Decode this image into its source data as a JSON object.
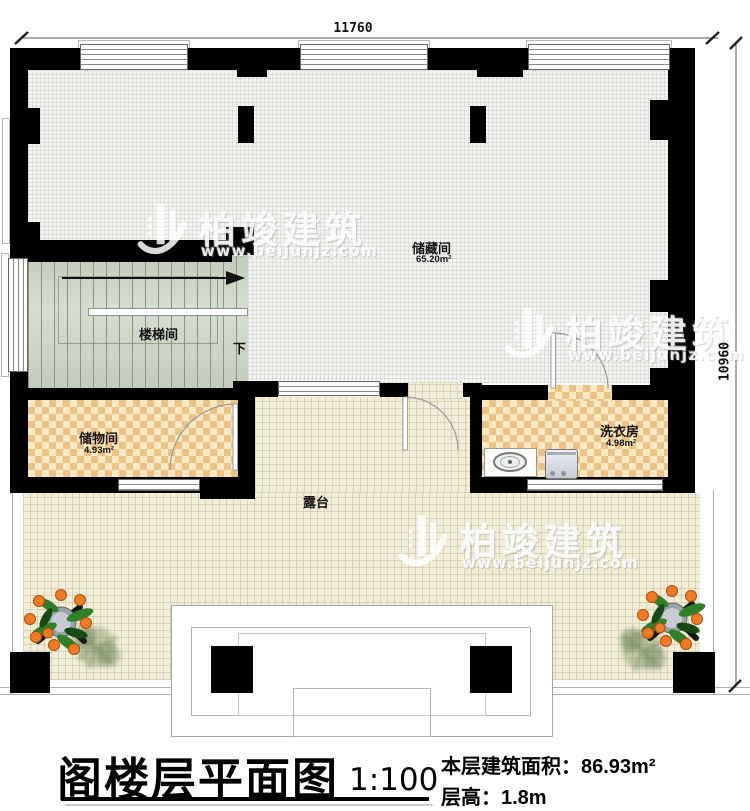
{
  "dimensions": {
    "top": "11760",
    "right": "10960"
  },
  "rooms": {
    "storage": {
      "name": "储藏间",
      "area": "65.20m²"
    },
    "stair": {
      "name": "楼梯间",
      "down": "下"
    },
    "storeroom": {
      "name": "储物间",
      "area": "4.93m²"
    },
    "laundry": {
      "name": "洗衣房",
      "area": "4.98m²"
    },
    "terrace": {
      "name": "露台"
    }
  },
  "watermark": {
    "brand": "柏竣建筑",
    "url": "www.beijunjz.com"
  },
  "title": {
    "main": "阁楼层平面图",
    "scale": "1:100",
    "area_label": "本层建筑面积：",
    "area_value": "86.93m²",
    "height_label": "层高：",
    "height_value": "1.8m"
  },
  "colors": {
    "wall": "#000000",
    "checker_dark": "#ecc285",
    "checker_light": "#f8e8c4",
    "terrace_floor": "#f1edd8",
    "stair_floor": "#ccd4c5",
    "storage_floor": "#f4f4f2",
    "fruit": "#ef7b24",
    "leaf": "#2e8128"
  }
}
